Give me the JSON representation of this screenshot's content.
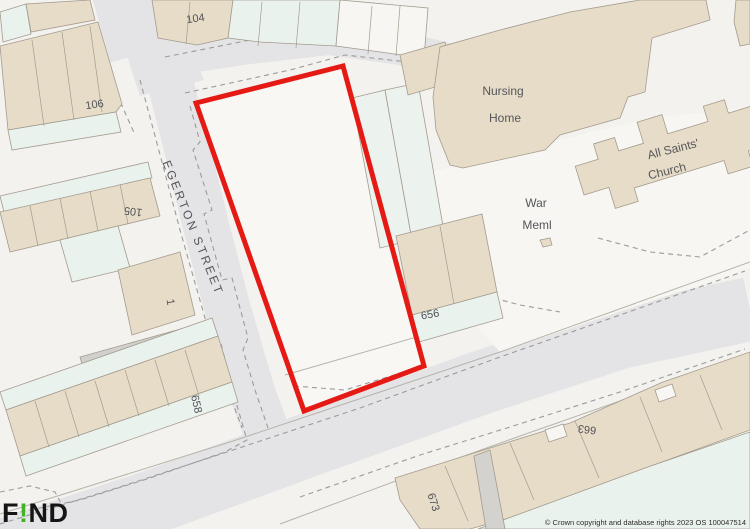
{
  "attribution": {
    "text": "© Crown copyright and database rights 2023 OS 100047514"
  },
  "branding": {
    "prefix": "F",
    "accent": "!",
    "suffix": "ND"
  },
  "map": {
    "street_label": "EGERTON STREET",
    "buildings": {
      "nursing_home": {
        "line1": "Nursing",
        "line2": "Home"
      },
      "church": {
        "line1": "All Saints'",
        "line2": "Church"
      },
      "war_memorial": {
        "line1": "War",
        "line2": "Meml"
      }
    },
    "plot_numbers": {
      "p104": "104",
      "p105": "105",
      "p106": "106",
      "p1": "1",
      "p656": "656",
      "p658": "658",
      "p663": "663",
      "p673": "673"
    },
    "colors": {
      "background": "#f3f2ee",
      "road_fill": "#e4e4e7",
      "building_fill": "#e7dcc8",
      "building_rear_fill": "#eaf2ed",
      "boundary_red": "#e51a14",
      "label_color": "#515257",
      "logo_green": "#41b226"
    }
  }
}
